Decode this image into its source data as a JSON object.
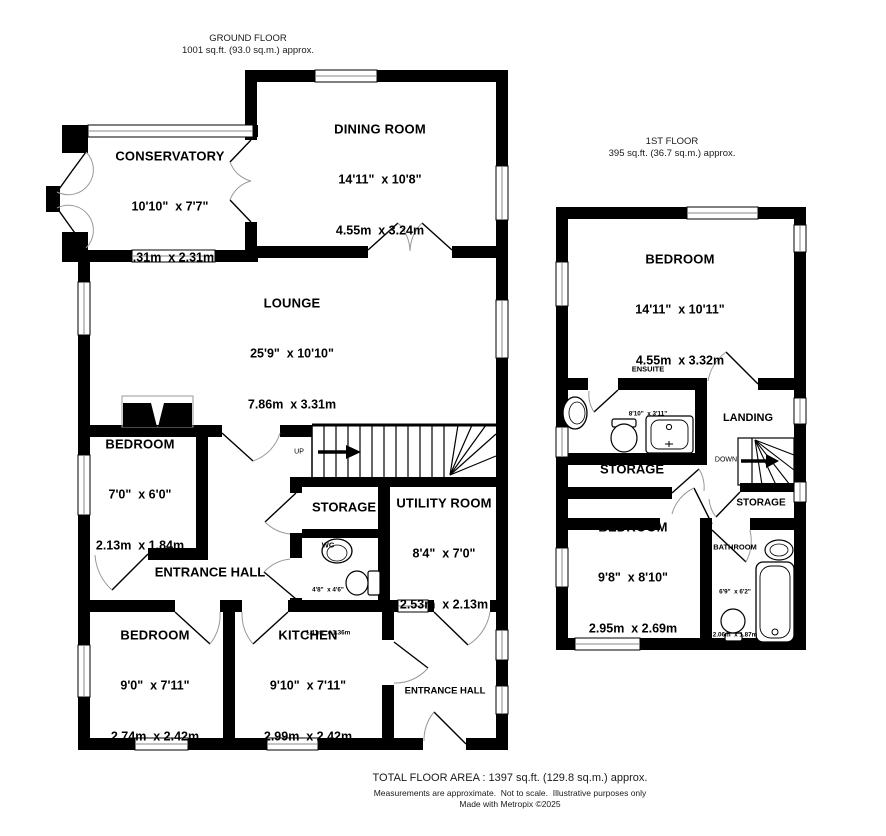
{
  "ground_header": {
    "title": "GROUND FLOOR",
    "area": "1001 sq.ft. (93.0 sq.m.) approx."
  },
  "first_header": {
    "title": "1ST FLOOR",
    "area": "395 sq.ft. (36.7 sq.m.) approx."
  },
  "ground": {
    "conservatory": {
      "name": "CONSERVATORY",
      "imperial": "10'10\"  x 7'7\"",
      "metric": "3.31m  x 2.31m"
    },
    "dining": {
      "name": "DINING ROOM",
      "imperial": "14'11\"  x 10'8\"",
      "metric": "4.55m  x 3.24m"
    },
    "lounge": {
      "name": "LOUNGE",
      "imperial": "25'9\"  x 10'10\"",
      "metric": "7.86m  x 3.31m"
    },
    "bedroom_small": {
      "name": "BEDROOM",
      "imperial": "7'0\"  x 6'0\"",
      "metric": "2.13m  x 1.84m"
    },
    "storage": {
      "name": "STORAGE"
    },
    "utility": {
      "name": "UTILITY ROOM",
      "imperial": "8'4\"  x 7'0\"",
      "metric": "2.53m  x 2.13m"
    },
    "wc": {
      "name": "WC",
      "imperial": "4'8\"  x 4'6\"",
      "metric": "1.41m  x 1.36m"
    },
    "entrance_hall": {
      "name": "ENTRANCE HALL"
    },
    "bedroom_left": {
      "name": "BEDROOM",
      "imperial": "9'0\"  x 7'11\"",
      "metric": "2.74m  x 2.42m"
    },
    "kitchen": {
      "name": "KITCHEN",
      "imperial": "9'10\"  x 7'11\"",
      "metric": "2.99m  x 2.42m"
    },
    "entrance_hall_2": {
      "name": "ENTRANCE HALL"
    },
    "up": "UP"
  },
  "first": {
    "bedroom_main": {
      "name": "BEDROOM",
      "imperial": "14'11\"  x 10'11\"",
      "metric": "4.55m  x 3.32m"
    },
    "ensuite": {
      "name": "ENSUITE",
      "imperial": "8'10\"  x 3'11\"",
      "metric": "2.69m  x 1.20m"
    },
    "landing": {
      "name": "LANDING"
    },
    "storage_left": {
      "name": "STORAGE"
    },
    "storage_right": {
      "name": "STORAGE"
    },
    "bedroom_rear": {
      "name": "BEDROOM",
      "imperial": "9'8\"  x 8'10\"",
      "metric": "2.95m  x 2.69m"
    },
    "bathroom": {
      "name": "BATHROOM",
      "imperial": "6'9\"  x 6'2\"",
      "metric": "2.06m  x 1.87m"
    },
    "down": "DOWN"
  },
  "footer": {
    "total": "TOTAL FLOOR AREA : 1397 sq.ft. (129.8 sq.m.) approx.",
    "disclaimer": "Measurements are approximate.  Not to scale.  Illustrative purposes only",
    "credit": "Made with Metropix ©2025"
  },
  "colors": {
    "wall": "#000000",
    "background": "#ffffff",
    "door_arc": "#999999"
  }
}
